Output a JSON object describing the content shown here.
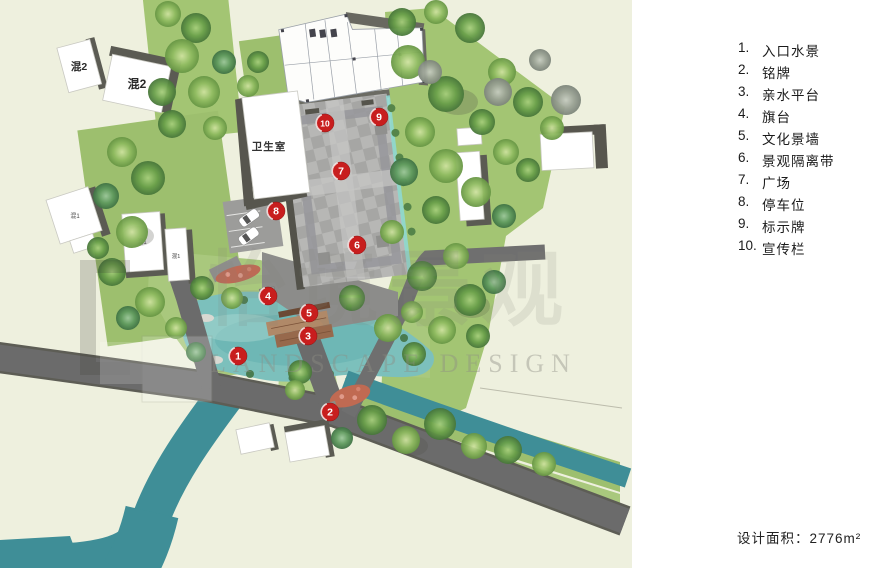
{
  "legend": {
    "items": [
      {
        "num": "1.",
        "label": "入口水景"
      },
      {
        "num": "2.",
        "label": "铭牌"
      },
      {
        "num": "3.",
        "label": "亲水平台"
      },
      {
        "num": "4.",
        "label": "旗台"
      },
      {
        "num": "5.",
        "label": "文化景墙"
      },
      {
        "num": "6.",
        "label": "景观隔离带"
      },
      {
        "num": "7.",
        "label": "广场"
      },
      {
        "num": "8.",
        "label": "停车位"
      },
      {
        "num": "9.",
        "label": "标示牌"
      },
      {
        "num": "10.",
        "label": "宣传栏"
      }
    ]
  },
  "footer": {
    "area_label": "设计面积：2776m²"
  },
  "plan": {
    "buildings": {
      "b1": "混2",
      "b2": "混2",
      "clinic": "卫生室",
      "small1": "混1",
      "small2": "混1",
      "small3": "混1"
    },
    "watermark": {
      "cjk": "怡境景观",
      "en": "LANDSCAPE DESIGN"
    },
    "markers": [
      {
        "n": "1",
        "x": 238,
        "y": 356
      },
      {
        "n": "2",
        "x": 330,
        "y": 412
      },
      {
        "n": "3",
        "x": 308,
        "y": 336
      },
      {
        "n": "4",
        "x": 268,
        "y": 296
      },
      {
        "n": "5",
        "x": 309,
        "y": 313
      },
      {
        "n": "6",
        "x": 357,
        "y": 245
      },
      {
        "n": "7",
        "x": 341,
        "y": 171
      },
      {
        "n": "8",
        "x": 276,
        "y": 211
      },
      {
        "n": "9",
        "x": 379,
        "y": 117
      },
      {
        "n": "10",
        "x": 325,
        "y": 123
      }
    ]
  },
  "colors": {
    "marker_red": "#c81e1e",
    "pond": "#7cc0bc",
    "stream": "#3f8e97",
    "road": "#6b6b6b",
    "green": "#a3c573",
    "paper": "#eef0de"
  }
}
